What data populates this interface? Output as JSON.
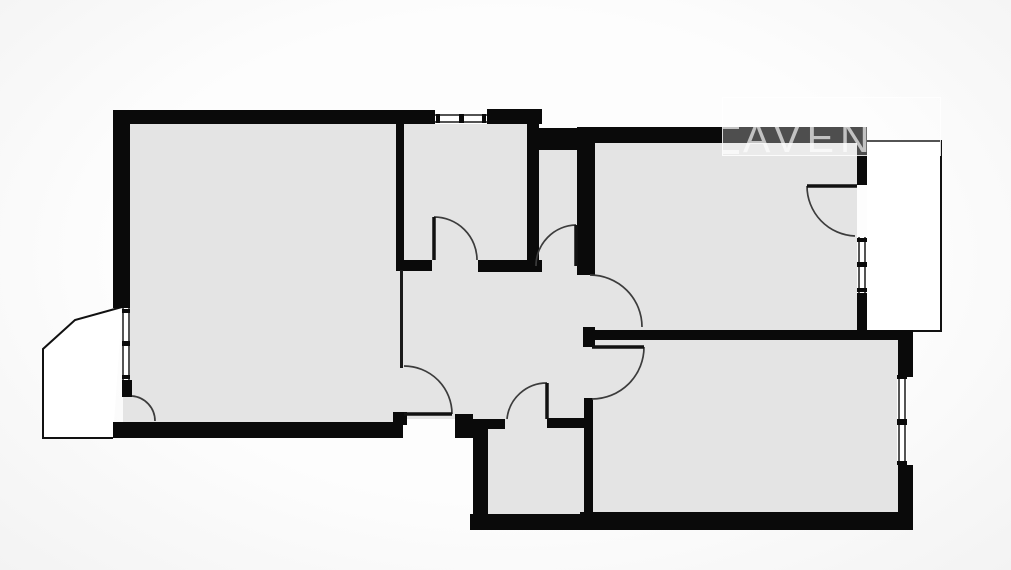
{
  "watermark": {
    "text": "AVEN",
    "box": {
      "x": 722,
      "y": 97,
      "w": 219,
      "h": 59
    },
    "bracket_x": 712
  },
  "colors": {
    "background": "#fbfbfb",
    "wall": "#0a0a0a",
    "room": "#e4e4e4",
    "thin_line": "#1a1a1a",
    "door_arc": "#3c3c3c",
    "door_leaf": "#111111",
    "balcony_fill": "#ffffff",
    "balcony_stroke": "#111111",
    "window_fill": "#ffffff",
    "watermark_tint": "rgba(255,255,255,0.66)"
  },
  "floorplan": {
    "canvas": {
      "w": 1011,
      "h": 570
    },
    "balconies": [
      {
        "name": "balcony-left",
        "path": "M122 307 L75 320 L43 349 L43 438 L113 438",
        "closed": false
      },
      {
        "name": "balcony-right",
        "path": "M867 141 L941 141 L941 331 L867 331",
        "closed": false
      }
    ],
    "rooms": [
      {
        "name": "living-room",
        "r": [
          123,
          122,
          274,
          301
        ]
      },
      {
        "name": "room-top-middle",
        "r": [
          404,
          123,
          124,
          138
        ]
      },
      {
        "name": "wc-corridor",
        "r": [
          538,
          150,
          39,
          112
        ]
      },
      {
        "name": "room-top-right",
        "r": [
          593,
          143,
          264,
          187
        ]
      },
      {
        "name": "hallway",
        "r": [
          397,
          260,
          196,
          159
        ]
      },
      {
        "name": "room-bottom-middle",
        "r": [
          473,
          419,
          120,
          96
        ]
      },
      {
        "name": "room-bottom-right",
        "r": [
          585,
          340,
          313,
          174
        ]
      }
    ],
    "walls": [
      {
        "name": "wall-top-main",
        "r": [
          113,
          110,
          322,
          14
        ]
      },
      {
        "name": "wall-top-right-of-window",
        "r": [
          487,
          109,
          55,
          15
        ]
      },
      {
        "name": "wall-left-upper",
        "r": [
          113,
          110,
          17,
          198
        ]
      },
      {
        "name": "wall-left-stub",
        "r": [
          122,
          380,
          10,
          17
        ]
      },
      {
        "name": "wall-living-bottom",
        "r": [
          113,
          422,
          290,
          16
        ]
      },
      {
        "name": "wall-living-middle-shared",
        "r": [
          396,
          110,
          8,
          160
        ]
      },
      {
        "name": "wall-door-post-living",
        "r": [
          393,
          412,
          14,
          13
        ]
      },
      {
        "name": "wall-middle-bottom-left",
        "r": [
          396,
          260,
          36,
          11
        ]
      },
      {
        "name": "wall-middle-bottom-right",
        "r": [
          478,
          260,
          54,
          12
        ]
      },
      {
        "name": "wall-wc-door-jamb",
        "r": [
          532,
          260,
          10,
          12
        ]
      },
      {
        "name": "wall-middle-wc-shared",
        "r": [
          527,
          110,
          12,
          161
        ]
      },
      {
        "name": "wall-wc-top",
        "r": [
          539,
          128,
          38,
          22
        ]
      },
      {
        "name": "wall-rightroom-left",
        "r": [
          577,
          127,
          18,
          148
        ]
      },
      {
        "name": "wall-rightroom-top",
        "r": [
          577,
          127,
          290,
          16
        ]
      },
      {
        "name": "wall-rightroom-right-upper",
        "r": [
          857,
          135,
          10,
          50
        ]
      },
      {
        "name": "wall-rightroom-right-lower",
        "r": [
          857,
          293,
          10,
          39
        ]
      },
      {
        "name": "wall-corner-post-hall",
        "r": [
          583,
          327,
          12,
          20
        ]
      },
      {
        "name": "wall-divider-right-rooms",
        "r": [
          585,
          330,
          328,
          10
        ]
      },
      {
        "name": "wall-bottomrooms-shared",
        "r": [
          584,
          398,
          9,
          117
        ]
      },
      {
        "name": "wall-bm-top-left-stub",
        "r": [
          455,
          414,
          18,
          24
        ]
      },
      {
        "name": "wall-bm-top-left",
        "r": [
          455,
          419,
          50,
          10
        ]
      },
      {
        "name": "wall-bm-top-right",
        "r": [
          547,
          418,
          46,
          10
        ]
      },
      {
        "name": "wall-bm-left",
        "r": [
          473,
          423,
          15,
          92
        ]
      },
      {
        "name": "wall-bm-bottom",
        "r": [
          470,
          514,
          123,
          16
        ]
      },
      {
        "name": "wall-br-bottom",
        "r": [
          580,
          512,
          333,
          18
        ]
      },
      {
        "name": "wall-br-right-upper",
        "r": [
          898,
          330,
          15,
          47
        ]
      },
      {
        "name": "wall-br-right-lower",
        "r": [
          898,
          465,
          15,
          47
        ]
      }
    ],
    "thin_walls": [
      {
        "name": "thin-wall-living-right",
        "r": [
          400,
          270,
          3,
          98
        ]
      }
    ],
    "windows": [
      {
        "name": "window-top-middle",
        "frame": [
          435,
          110,
          52,
          14
        ],
        "lines": [
          [
            435,
            115,
            487,
            115
          ],
          [
            435,
            122,
            487,
            122
          ]
        ],
        "ticks": [
          [
            436,
            114,
            4,
            9
          ],
          [
            459,
            114,
            5,
            9
          ],
          [
            482,
            114,
            4,
            9
          ]
        ]
      },
      {
        "name": "window-living-left",
        "frame": [
          122,
          308,
          8,
          72
        ],
        "lines": [
          [
            123,
            308,
            123,
            380
          ],
          [
            129,
            308,
            129,
            380
          ]
        ],
        "ticks": [
          [
            122,
            309,
            8,
            4
          ],
          [
            122,
            341,
            8,
            5
          ],
          [
            122,
            375,
            8,
            4
          ]
        ]
      },
      {
        "name": "window-rightroom-balcony",
        "frame": [
          857,
          237,
          10,
          56
        ],
        "lines": [
          [
            859,
            237,
            859,
            293
          ],
          [
            865,
            237,
            865,
            293
          ]
        ],
        "ticks": [
          [
            857,
            238,
            10,
            4
          ],
          [
            857,
            262,
            10,
            5
          ],
          [
            857,
            288,
            10,
            4
          ]
        ]
      },
      {
        "name": "window-bottomright",
        "frame": [
          897,
          375,
          10,
          90
        ],
        "lines": [
          [
            899,
            375,
            899,
            465
          ],
          [
            905,
            375,
            905,
            465
          ]
        ],
        "ticks": [
          [
            897,
            375,
            10,
            4
          ],
          [
            897,
            419,
            10,
            6
          ],
          [
            897,
            461,
            10,
            4
          ]
        ]
      }
    ],
    "doors": [
      {
        "name": "door-top-middle-room",
        "leaf": [
          434,
          217,
          434,
          260
        ],
        "arc": "M434 217 A43 43 0 0 1 477 260"
      },
      {
        "name": "door-wc",
        "leaf": [
          576,
          225,
          576,
          266
        ],
        "arc": "M576 225 A41 41 0 0 0 536 266"
      },
      {
        "name": "door-living",
        "leaf": [
          404,
          414,
          452,
          414
        ],
        "arc": "M404 366 A48 48 0 0 1 452 414"
      },
      {
        "name": "door-bottom-middle-room",
        "leaf": [
          547,
          383,
          547,
          419
        ],
        "arc": "M507 419 A40 40 0 0 1 547 383"
      },
      {
        "name": "door-top-right-room",
        "leaf": null,
        "arc": "M590 275 A52 52 0 0 1 642 327"
      },
      {
        "name": "door-bottom-right-room",
        "leaf": [
          592,
          347,
          644,
          347
        ],
        "arc": "M644 347 A52 52 0 0 1 592 399"
      },
      {
        "name": "door-right-balcony",
        "leaf": [
          807,
          186,
          857,
          186
        ],
        "arc": "M807 186 A50 50 0 0 0 855 236"
      },
      {
        "name": "door-left-balcony",
        "leaf": null,
        "arc": "M132 396 A25 25 0 0 1 155 421"
      }
    ]
  }
}
